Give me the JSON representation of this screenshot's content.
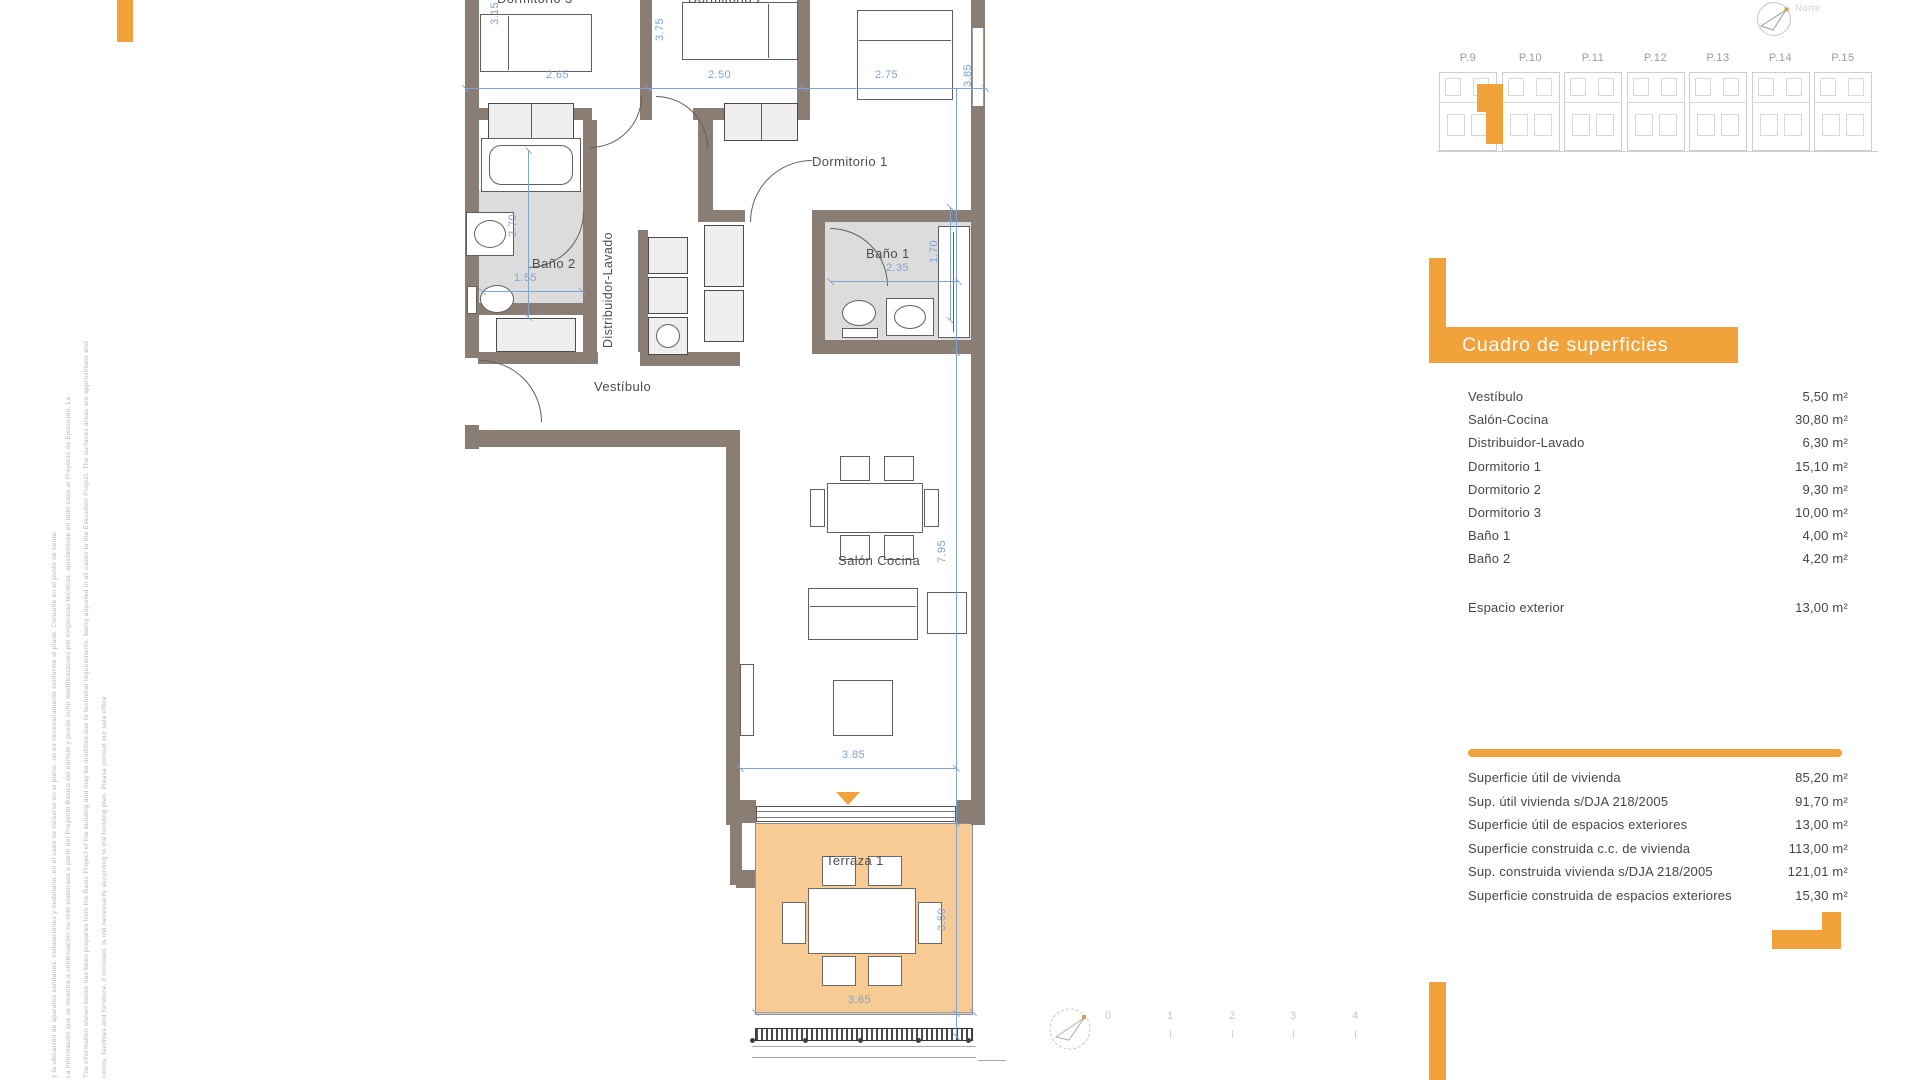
{
  "colors": {
    "accent": "#F2A23B",
    "terrace_fill": "#F9CB94",
    "wall": "#8A7D74",
    "dim_blue": "#7FA3D2",
    "bath_gray": "#DCDCDC"
  },
  "compass": {
    "north_label": "Norte"
  },
  "key_plan": {
    "unit_labels": [
      "P.9",
      "P.10",
      "P.11",
      "P.12",
      "P.13",
      "P.14",
      "P.15"
    ],
    "highlighted_unit": "P.9"
  },
  "floor_plan": {
    "room_labels": [
      {
        "text": "Dormitorio 3",
        "x": 497,
        "y": -9
      },
      {
        "text": "Dormitorio 2",
        "x": 688,
        "y": -9
      },
      {
        "text": "Dormitorio 1",
        "x": 812,
        "y": 154
      },
      {
        "text": "Baño 2",
        "x": 532,
        "y": 256
      },
      {
        "text": "Baño 1",
        "x": 866,
        "y": 246
      },
      {
        "text": "Vestíbulo",
        "x": 594,
        "y": 379
      },
      {
        "text": "Salón Cocina",
        "x": 838,
        "y": 553
      },
      {
        "text": "Terraza 1",
        "x": 826,
        "y": 853
      },
      {
        "text": "Distribuidor-Lavado",
        "x": 601,
        "y": 168,
        "rot": true
      }
    ],
    "dim_labels": [
      {
        "text": "2.65",
        "x": 546,
        "y": 69
      },
      {
        "text": "2.50",
        "x": 708,
        "y": 69
      },
      {
        "text": "2.75",
        "x": 875,
        "y": 69
      },
      {
        "text": "3.15",
        "x": 489,
        "y": 2,
        "rot": true
      },
      {
        "text": "3.75",
        "x": 654,
        "y": 18,
        "rot": true
      },
      {
        "text": "3.85",
        "x": 962,
        "y": 64,
        "rot": true
      },
      {
        "text": "2.70",
        "x": 507,
        "y": 214,
        "rot": true
      },
      {
        "text": "1.55",
        "x": 514,
        "y": 272
      },
      {
        "text": "2.35",
        "x": 886,
        "y": 262
      },
      {
        "text": "1.70",
        "x": 928,
        "y": 240,
        "rot": true
      },
      {
        "text": "7.95",
        "x": 936,
        "y": 540,
        "rot": true
      },
      {
        "text": "3.85",
        "x": 842,
        "y": 749
      },
      {
        "text": "3.50",
        "x": 936,
        "y": 908,
        "rot": true
      },
      {
        "text": "3.65",
        "x": 848,
        "y": 994
      }
    ]
  },
  "surfaces": {
    "title": "Cuadro de superficies",
    "rows": [
      {
        "label": "Vestíbulo",
        "value": "5,50 m²"
      },
      {
        "label": "Salón-Cocina",
        "value": "30,80 m²"
      },
      {
        "label": "Distribuidor-Lavado",
        "value": "6,30 m²"
      },
      {
        "label": "Dormitorio 1",
        "value": "15,10 m²"
      },
      {
        "label": "Dormitorio 2",
        "value": "9,30 m²"
      },
      {
        "label": "Dormitorio 3",
        "value": "10,00 m²"
      },
      {
        "label": "Baño 1",
        "value": "4,00 m²"
      },
      {
        "label": "Baño 2",
        "value": "4,20 m²"
      }
    ],
    "exterior_row": {
      "label": "Espacio exterior",
      "value": "13,00 m²"
    },
    "summary_rows": [
      {
        "label": "Superficie útil de vivienda",
        "value": "85,20 m²"
      },
      {
        "label": "Sup. útil vivienda s/DJA 218/2005",
        "value": "91,70 m²"
      },
      {
        "label": "Superficie útil de espacios exteriores",
        "value": "13,00 m²"
      },
      {
        "label": "Superficie construida c.c. de vivienda",
        "value": "113,00 m²"
      },
      {
        "label": "Sup. construida vivienda s/DJA 218/2005",
        "value": "121,01 m²"
      },
      {
        "label": "Superficie construida de espacios exteriores",
        "value": "15,30 m²"
      }
    ]
  },
  "scale_bar": {
    "labels": [
      "0",
      "1",
      "2",
      "3",
      "4"
    ]
  },
  "disclaimer": {
    "columns": [
      "y la ubicación de aparatos sanitarios, instalaciones y mobiliario, en el caso de incluirse en el plano, no es necesariamente conforme al plano. Consulte en el punto de venta.",
      "La información que se muestra a continuación ha sido elaborada a partir del Proyecto Básico del edificio y puede sufrir modificaciones por exigencias técnicas, ajustándose en todo caso al Proyecto de Ejecución. La",
      "The information shown below has been prepared from the Basic Project of the building and may be modified due to technical requirements, being adjusted in all cases to the Execution Project. The surfaces areas are approximate and",
      "rooms, facilities and furniture, if included, is not necessarily according to the building plan. Please consult our sale office."
    ]
  }
}
